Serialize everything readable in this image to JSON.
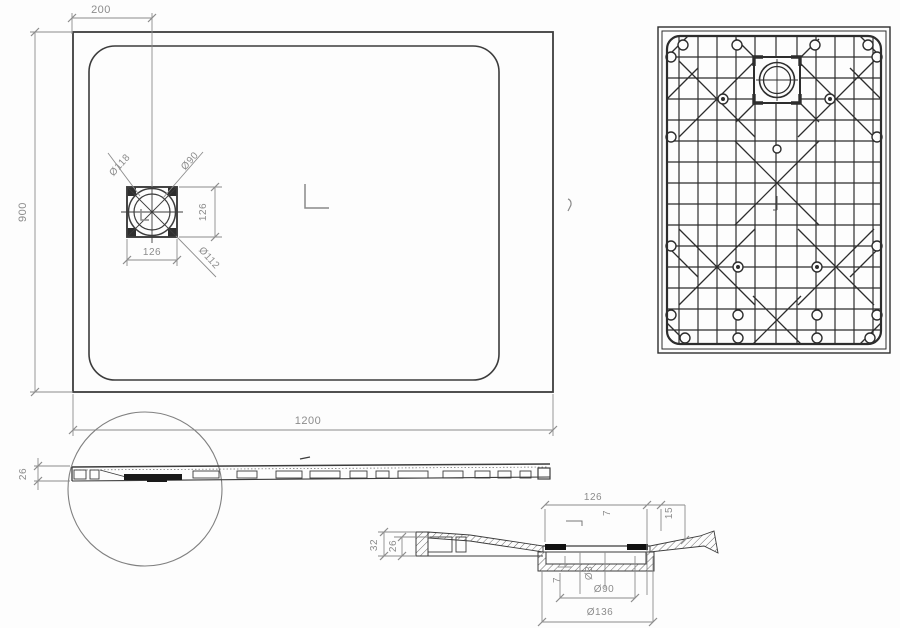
{
  "drawing": {
    "type": "technical-drawing-shower-tray",
    "colors": {
      "background": "#fdfdfd",
      "line": "#3c3c3c",
      "rib_line": "#2d2d2d",
      "dimension": "#8c8c8c",
      "seal_fill": "#1a1a1a"
    },
    "plan_view": {
      "dim_width": "1200",
      "dim_height": "900",
      "dim_drain_offset": "200",
      "dim_drain_square_w": "126",
      "dim_drain_square_h": "126",
      "dim_drain_outer_dia": "Ø118",
      "dim_drain_inner_dia": "Ø90",
      "dim_drain_corner_dia": "Ø112"
    },
    "side_view": {
      "dim_thickness": "26"
    },
    "section_view": {
      "dim_recess_width": "126",
      "dim_lip": "7",
      "dim_rim_height": "15",
      "dim_total_height": "32",
      "dim_inner_height": "26",
      "dim_wall": "7",
      "dim_hole_dia": "Ø3",
      "dim_drain_dia": "Ø90",
      "dim_flange_dia": "Ø136"
    }
  }
}
